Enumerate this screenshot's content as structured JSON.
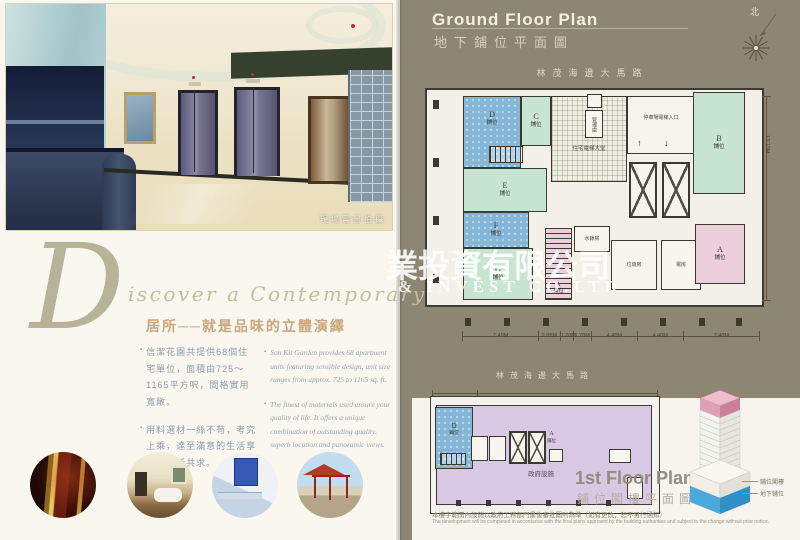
{
  "watermark": {
    "line1": "業投資有限公司",
    "line2": "& INVEST CO.LTD"
  },
  "left_page": {
    "photo_caption": "現場實景拍攝",
    "script_initial": "D",
    "script_rest": "iscover a Contemporary Classic",
    "heading": "居所──就是品味的立體演繹",
    "bullets_zh": [
      "信潔花園共提供68個住宅單位，面積由725～1165平方呎，間格實用寬敞。",
      "用料選材一絲不苟，考究上乘，達至滿意的生活享受，人所共求。"
    ],
    "bullets_en": [
      "Son Kit Garden provides 68 apartment units featuring sensible design, unit size ranges from approx. 725 to 1165 sq. ft.",
      "The finest of materials used ensure your quality of life. It offers a unique combination of outstanding quality, superb location and panoramic views."
    ]
  },
  "ground_plan": {
    "title_en": "Ground Floor Plan",
    "title_zh": "地下鋪位平面圖",
    "street": "林茂海邊大馬路",
    "compass_north": "北",
    "unit_suffix": "鋪位",
    "units": {
      "a": "A",
      "b": "B",
      "c": "C",
      "d": "D",
      "e": "E",
      "f": "F",
      "g": "G"
    },
    "rooms": {
      "lobby": "住宅電梯大堂",
      "office": "管理處",
      "carpark_entrance": "停車場電梯入口",
      "water_meter": "水錶房",
      "refuse": "垃圾房",
      "electrical": "電房"
    },
    "icons": {
      "arrow_up": "↑",
      "arrow_down": "↓"
    },
    "dims_bottom": [
      "7.40M",
      "2.05M",
      "1.20M",
      "1.70M",
      "4.40M",
      "4.40M",
      "7.40M"
    ],
    "dim_right": "13.10M"
  },
  "first_floor_plan": {
    "title_en": "1st Floor Plan",
    "title_zh": "鋪位閣樓平面圖",
    "street": "林茂海邊大馬路",
    "gov_area": "政府設施",
    "unit_d": "D",
    "unit_a": "A",
    "unit_suffix": "鋪位"
  },
  "building_diagram": {
    "label_mezzanine": "鋪位閣樓",
    "label_ground": "地下鋪位"
  },
  "disclaimer": {
    "zh": "本樓宇範圍內設施以政府工務部門最後審批圖則為準（如有更改，恕不另行通知）",
    "en": "The development will be completed in accordance with the final plans approved by the building authorities and subject to the change without prior notice."
  }
}
